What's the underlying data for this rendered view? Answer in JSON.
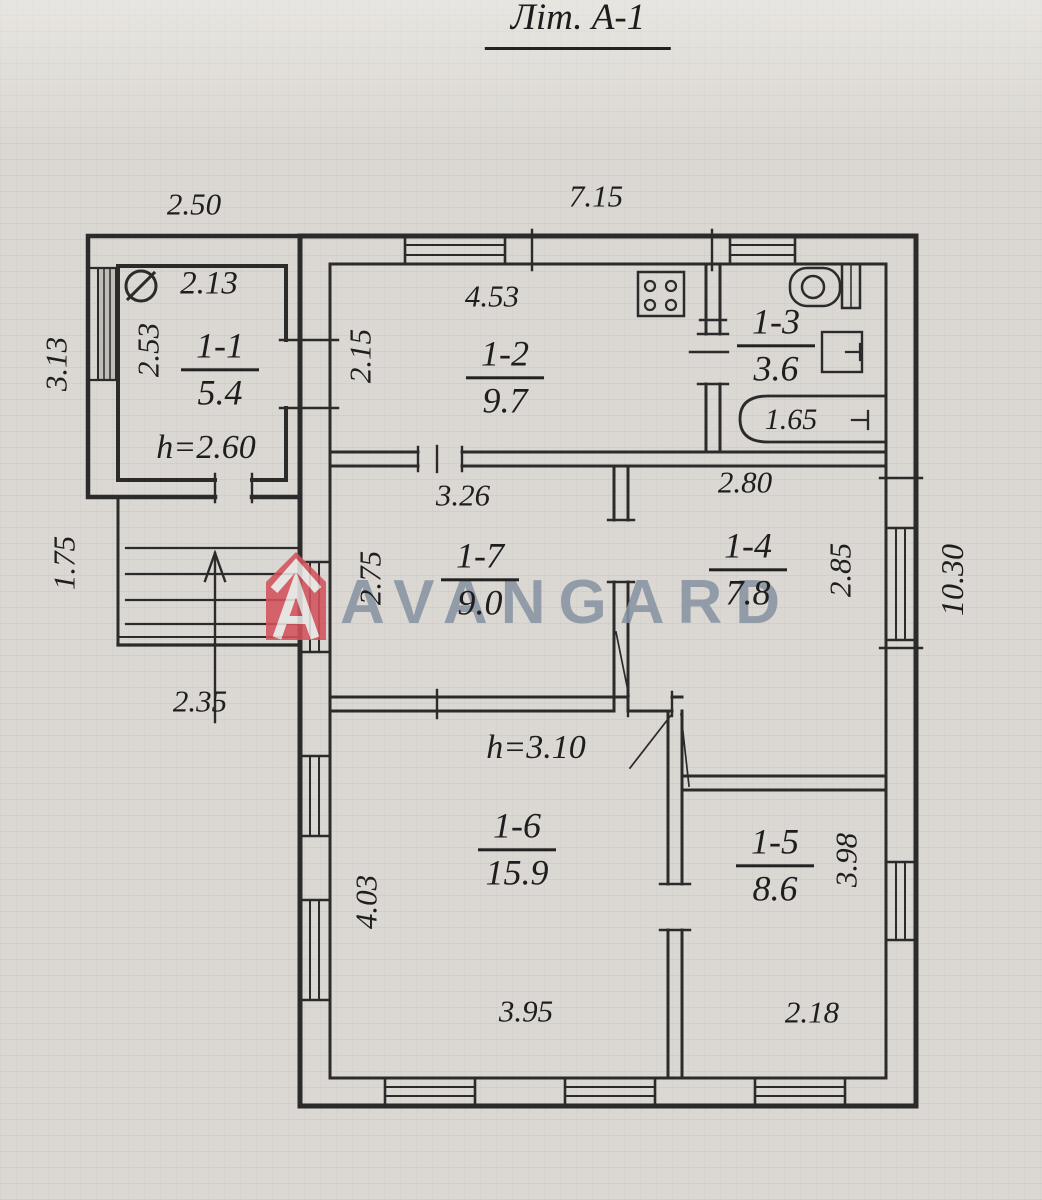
{
  "title": "Літ. А-1",
  "watermark": {
    "brand": "AVANGARD",
    "logo_color": "#d4525d",
    "text_color": "#8794a3"
  },
  "colors": {
    "paper": "#dbd8d3",
    "ink": "#2b2b2b"
  },
  "rooms": {
    "r11": {
      "num": "1-1",
      "area": "5.4"
    },
    "r12": {
      "num": "1-2",
      "area": "9.7"
    },
    "r13": {
      "num": "1-3",
      "area": "3.6"
    },
    "r14": {
      "num": "1-4",
      "area": "7.8"
    },
    "r15": {
      "num": "1-5",
      "area": "8.6"
    },
    "r16": {
      "num": "1-6",
      "area": "15.9"
    },
    "r17": {
      "num": "1-7",
      "area": "9.0"
    }
  },
  "dimensions": {
    "top_annex": "2.50",
    "top_main": "7.15",
    "annex_height_left": "3.13",
    "porch_height_left": "1.75",
    "porch_width": "2.35",
    "r11_width": "2.13",
    "r11_depth": "2.53",
    "r11_ceiling": "h=2.60",
    "r12_width": "4.53",
    "r12_depth": "2.15",
    "r13_bath_length": "1.65",
    "r17_width": "3.26",
    "r17_depth": "2.75",
    "r14_width": "2.80",
    "r14_depth": "2.85",
    "main_height_right": "10.30",
    "main_ceiling": "h=3.10",
    "r16_depth": "4.03",
    "r16_width": "3.95",
    "r15_depth": "3.98",
    "r15_width": "2.18"
  }
}
